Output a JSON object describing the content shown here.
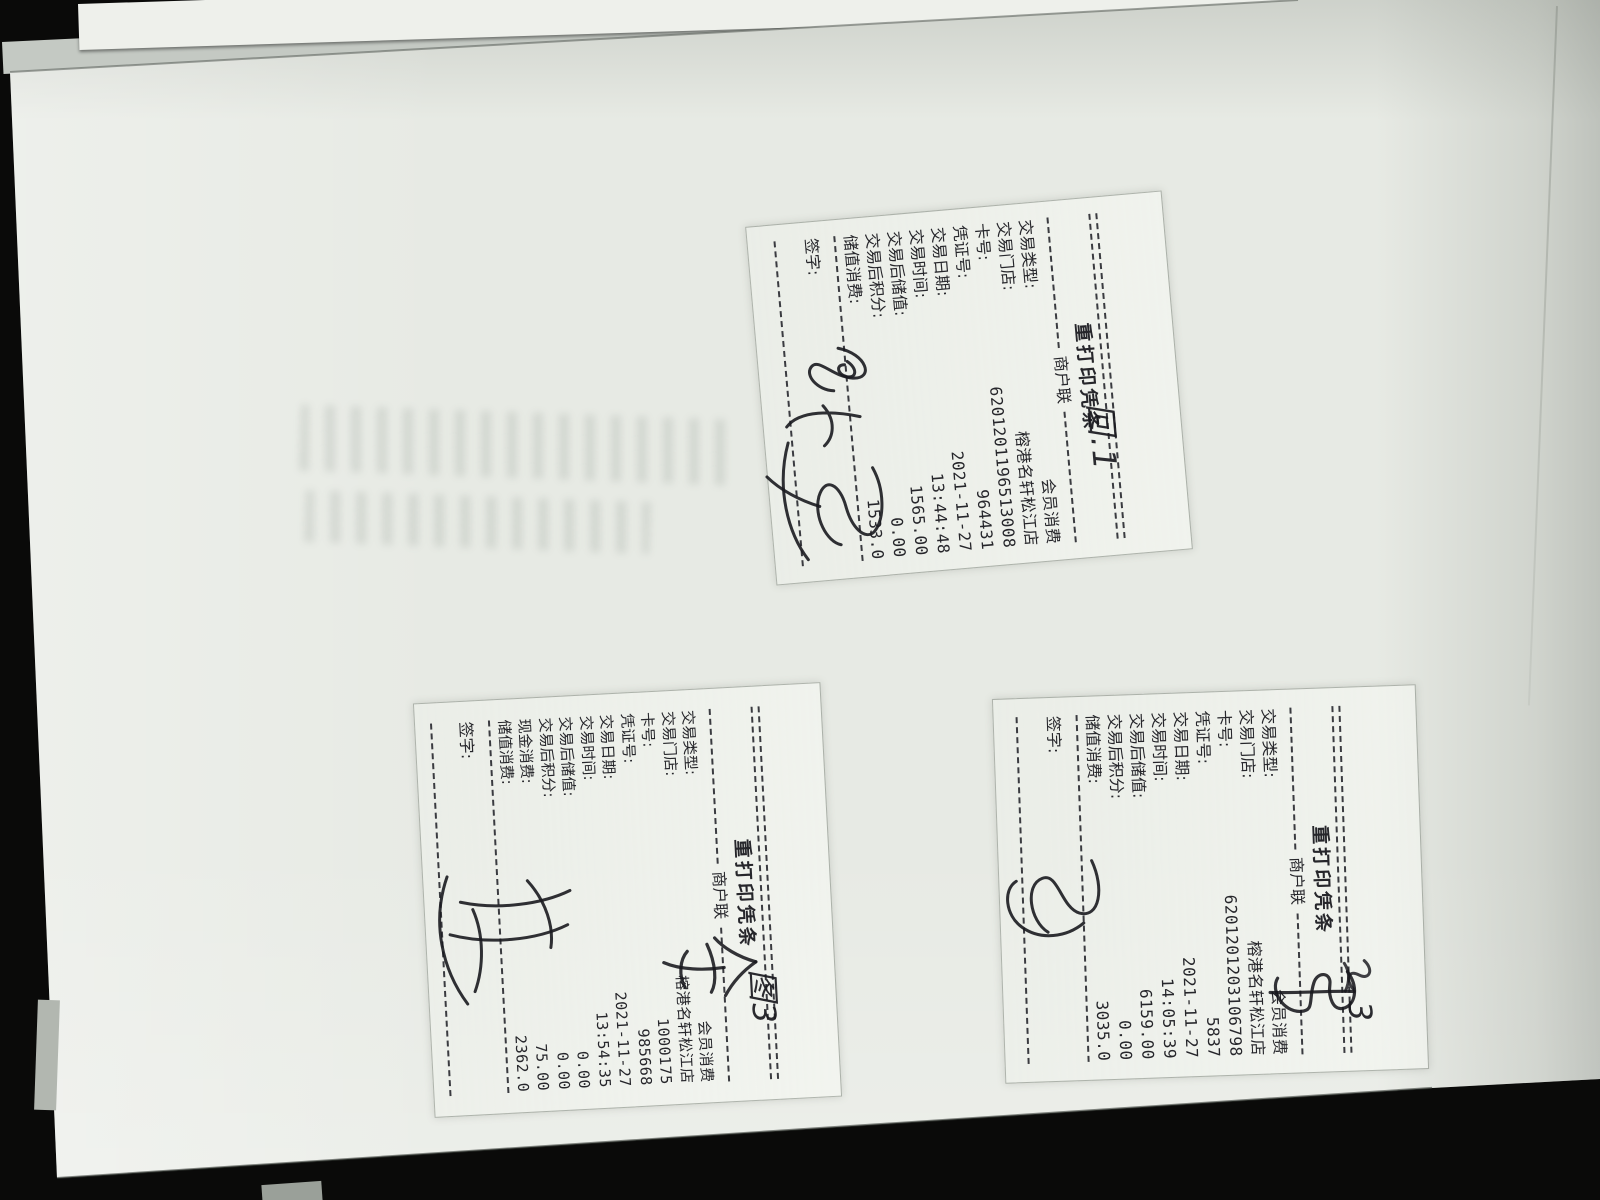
{
  "scene": {
    "background_color": "#0a0a09",
    "paper_color": "#e7eae4",
    "print_ink_color": "#26262b",
    "handwriting_ink_color": "#1a1a1f"
  },
  "receipts": [
    {
      "title": "重打印凭条",
      "copy_label": "商户联",
      "sign_label": "签字:",
      "handwritten_mark": "回.1",
      "signature": "handwritten-scribble",
      "fields": [
        {
          "label": "交易类型:",
          "value": "会员消费"
        },
        {
          "label": "交易门店:",
          "value": "榕港名轩松江店"
        },
        {
          "label": "卡号:",
          "value": "6201201196513008"
        },
        {
          "label": "凭证号:",
          "value": "964431"
        },
        {
          "label": "交易日期:",
          "value": "2021-11-27"
        },
        {
          "label": "交易时间:",
          "value": "13:44:48"
        },
        {
          "label": "交易后储值:",
          "value": "1565.00"
        },
        {
          "label": "交易后积分:",
          "value": "0.00"
        },
        {
          "label": "储值消费:",
          "value": "1533.0"
        }
      ]
    },
    {
      "title": "重打印凭条",
      "copy_label": "商户联",
      "sign_label": "签字:",
      "handwritten_mark": "3",
      "signature": "handwritten-scribble",
      "fields": [
        {
          "label": "交易类型:",
          "value": "会员消费"
        },
        {
          "label": "交易门店:",
          "value": "榕港名轩松江店"
        },
        {
          "label": "卡号:",
          "value": "6201201203106798"
        },
        {
          "label": "凭证号:",
          "value": "5837"
        },
        {
          "label": "交易日期:",
          "value": "2021-11-27"
        },
        {
          "label": "交易时间:",
          "value": "14:05:39"
        },
        {
          "label": "交易后储值:",
          "value": "6159.00"
        },
        {
          "label": "交易后积分:",
          "value": "0.00"
        },
        {
          "label": "储值消费:",
          "value": "3035.0"
        }
      ]
    },
    {
      "title": "重打印凭条",
      "copy_label": "商户联",
      "sign_label": "签字:",
      "handwritten_mark": "图3",
      "signature": "handwritten-scribble",
      "fields": [
        {
          "label": "交易类型:",
          "value": "会员消费"
        },
        {
          "label": "交易门店:",
          "value": "榕港名轩松江店"
        },
        {
          "label": "卡号:",
          "value": "1000175"
        },
        {
          "label": "凭证号:",
          "value": "985668"
        },
        {
          "label": "交易日期:",
          "value": "2021-11-27"
        },
        {
          "label": "交易时间:",
          "value": "13:54:35"
        },
        {
          "label": "交易后储值:",
          "value": "0.00"
        },
        {
          "label": "交易后积分:",
          "value": "0.00"
        },
        {
          "label": "现金消费:",
          "value": "75.00"
        },
        {
          "label": "储值消费:",
          "value": "2362.0"
        }
      ]
    }
  ]
}
